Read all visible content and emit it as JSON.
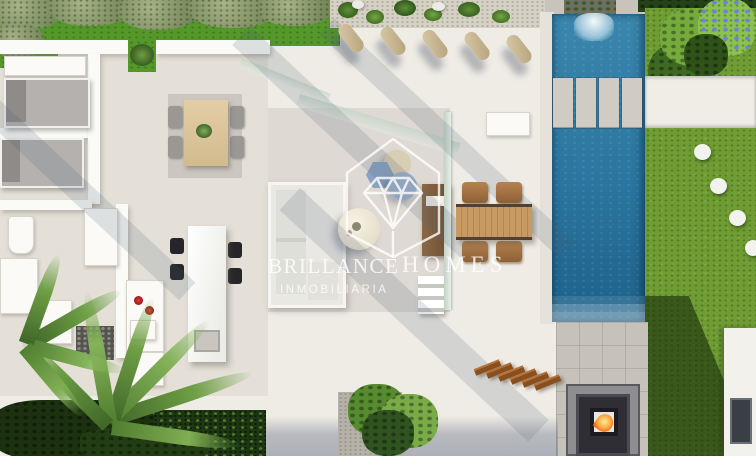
{
  "scene": {
    "type": "aerial-3d-render",
    "subject": "modern villa top view with pool, terrace and garden",
    "features": [
      "bedrooms with beds",
      "interior dining table with 4 chairs",
      "kitchen island with 4 stools",
      "living sofa with poufs and round table",
      "outdoor dining table with 4 chairs",
      "5 bolster cushions on terrace",
      "pool with waterfall and 4 crossing slabs",
      "lawn with 4 round stepping stones",
      "fire pit patio",
      "wooden steps",
      "palm trees and hedges"
    ]
  },
  "watermark": {
    "brand_word1": "BRILLANCE",
    "brand_word2": "HOMES",
    "subtitle": "INMOBILIARIA",
    "logo": "house-diamond-icon"
  },
  "colors": {
    "terrace": "#efece5",
    "interior_floor": "#e4e0d8",
    "wall_white": "#fafaf7",
    "pool_blue": "#2f7fa8",
    "pool_deep": "#1d6189",
    "lawn_green": "#6f9c33",
    "grass_bright": "#55982a",
    "hedge_dark": "#24421a",
    "olive_sage": "#8d9c6e",
    "wood_table": "#c08f58",
    "wood_steps": "#8a4f1f",
    "gravel": "#d6d1c5",
    "tile_gray": "#c6c2b9",
    "flame_orange": "#ff8a2a",
    "pouf_blue": "#8ba3c2",
    "pouf_beige": "#d9cdb4",
    "duvet_gray": "#b4b1ae",
    "shadow_blue": "#6d758c",
    "watermark_white": "#ffffff"
  }
}
